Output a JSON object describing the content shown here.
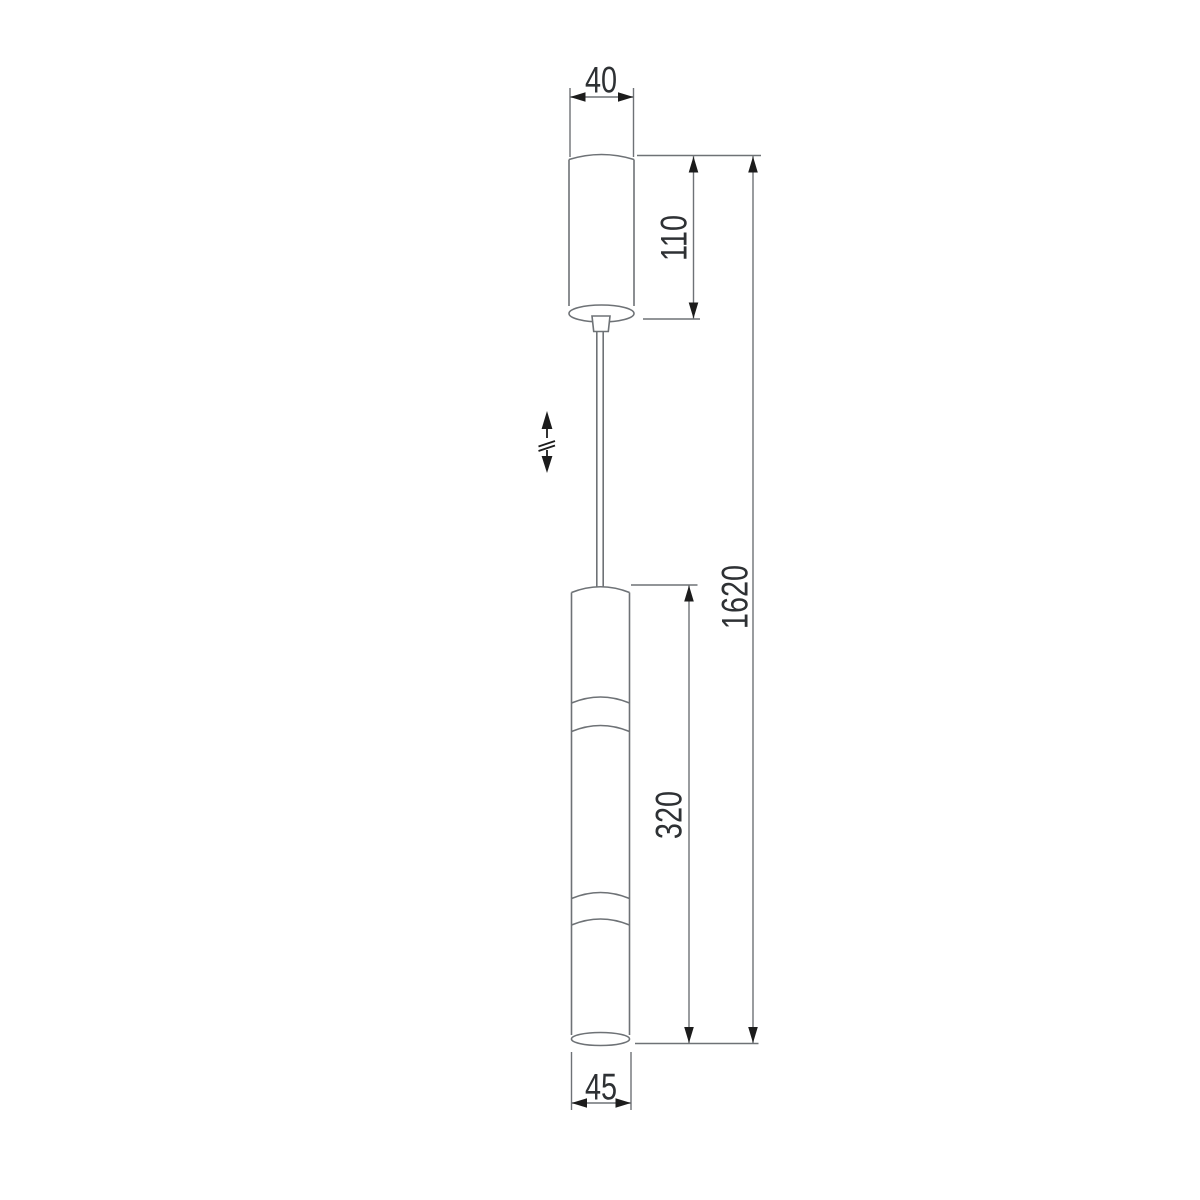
{
  "drawing": {
    "type": "technical-dimension-drawing",
    "subject": "pendant-light-fixture-side-view",
    "dimensions": {
      "canopy_diameter": "40",
      "canopy_height": "110",
      "overall_height": "1620",
      "lamp_body_height": "320",
      "lamp_body_diameter": "45"
    },
    "icons": {
      "height_adjust": "up-down-arrows-with-adjustment-break"
    },
    "colors": {
      "background": "#ffffff",
      "outline": "#6e7276",
      "dimension_line": "#6e7276",
      "arrow": "#1c1c1c",
      "text": "#2e3134"
    }
  }
}
